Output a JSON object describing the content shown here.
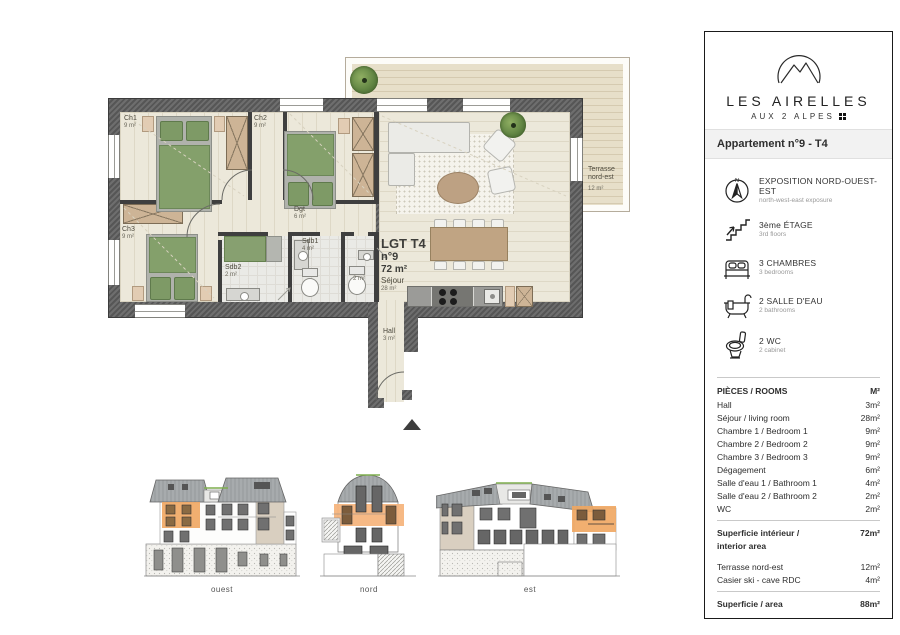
{
  "panel": {
    "brand_name": "LES AIRELLES",
    "brand_subtitle": "AUX 2 ALPES",
    "apartment_title": "Appartement n°9 - T4",
    "compass_n": "N",
    "features": [
      {
        "icon": "compass-icon",
        "label": "EXPOSITION NORD-OUEST-EST",
        "sublabel": "north-west-east exposure"
      },
      {
        "icon": "stairs-icon",
        "label": "3ème ÉTAGE",
        "sublabel": "3rd floors"
      },
      {
        "icon": "bed-icon",
        "label": "3 CHAMBRES",
        "sublabel": "3 bedrooms"
      },
      {
        "icon": "bathtub-icon",
        "label": "2 SALLE D'EAU",
        "sublabel": "2 bathrooms"
      },
      {
        "icon": "toilet-icon",
        "label": "2 WC",
        "sublabel": "2 cabinet"
      }
    ],
    "rooms_table": {
      "header_label": "PIÈCES / ROOMS",
      "header_value": "M²",
      "rows": [
        {
          "label": "Hall",
          "value": "3m²"
        },
        {
          "label": "Séjour / living room",
          "value": "28m²"
        },
        {
          "label": "Chambre 1 / Bedroom 1",
          "value": "9m²"
        },
        {
          "label": "Chambre 2 / Bedroom 2",
          "value": "9m²"
        },
        {
          "label": "Chambre 3 / Bedroom 3",
          "value": "9m²"
        },
        {
          "label": "Dégagement",
          "value": "6m²"
        },
        {
          "label": "Salle d'eau 1 / Bathroom 1",
          "value": "4m²"
        },
        {
          "label": "Salle d'eau 2 / Bathroom 2",
          "value": "2m²"
        },
        {
          "label": "WC",
          "value": "2m²"
        }
      ],
      "subtotal_label_line1": "Superficie intérieur /",
      "subtotal_label_line2": "interior area",
      "subtotal_value": "72m²",
      "extras": [
        {
          "label": "Terrasse nord-est",
          "value": "12m²"
        },
        {
          "label": "Casier ski - cave RDC",
          "value": "4m²"
        }
      ],
      "total_label": "Superficie / area",
      "total_value": "88m²"
    }
  },
  "plan": {
    "unit": {
      "id": "LGT T4",
      "number": "n°9",
      "area": "72 m²",
      "room": "Séjour",
      "room_area": "28 m²"
    },
    "rooms": {
      "ch1": {
        "name": "Ch1",
        "area": "9 m²"
      },
      "ch2": {
        "name": "Ch2",
        "area": "9 m²"
      },
      "ch3": {
        "name": "Ch3",
        "area": "9 m²"
      },
      "dgt": {
        "name": "Dgt",
        "area": "6 m²"
      },
      "sdb1": {
        "name": "Sdb1",
        "area": "4 m²"
      },
      "sdb2": {
        "name": "Sdb2",
        "area": "2 m²"
      },
      "wc": {
        "area": "2 m²"
      },
      "hall": {
        "name": "Hall",
        "area": "3 m²"
      }
    },
    "terrace": {
      "name_line1": "Terrasse",
      "name_line2": "nord-est",
      "area": "12 m²"
    }
  },
  "elevations": {
    "west": "ouest",
    "north": "nord",
    "east": "est"
  },
  "colors": {
    "accent_orange": "#f0a660",
    "wall_gray": "#5f5f5f",
    "floor_cream": "#ece8da",
    "bed_green": "#85a06c",
    "wood_tan": "#cdb496",
    "terrace_beige": "#e7dfc9"
  }
}
